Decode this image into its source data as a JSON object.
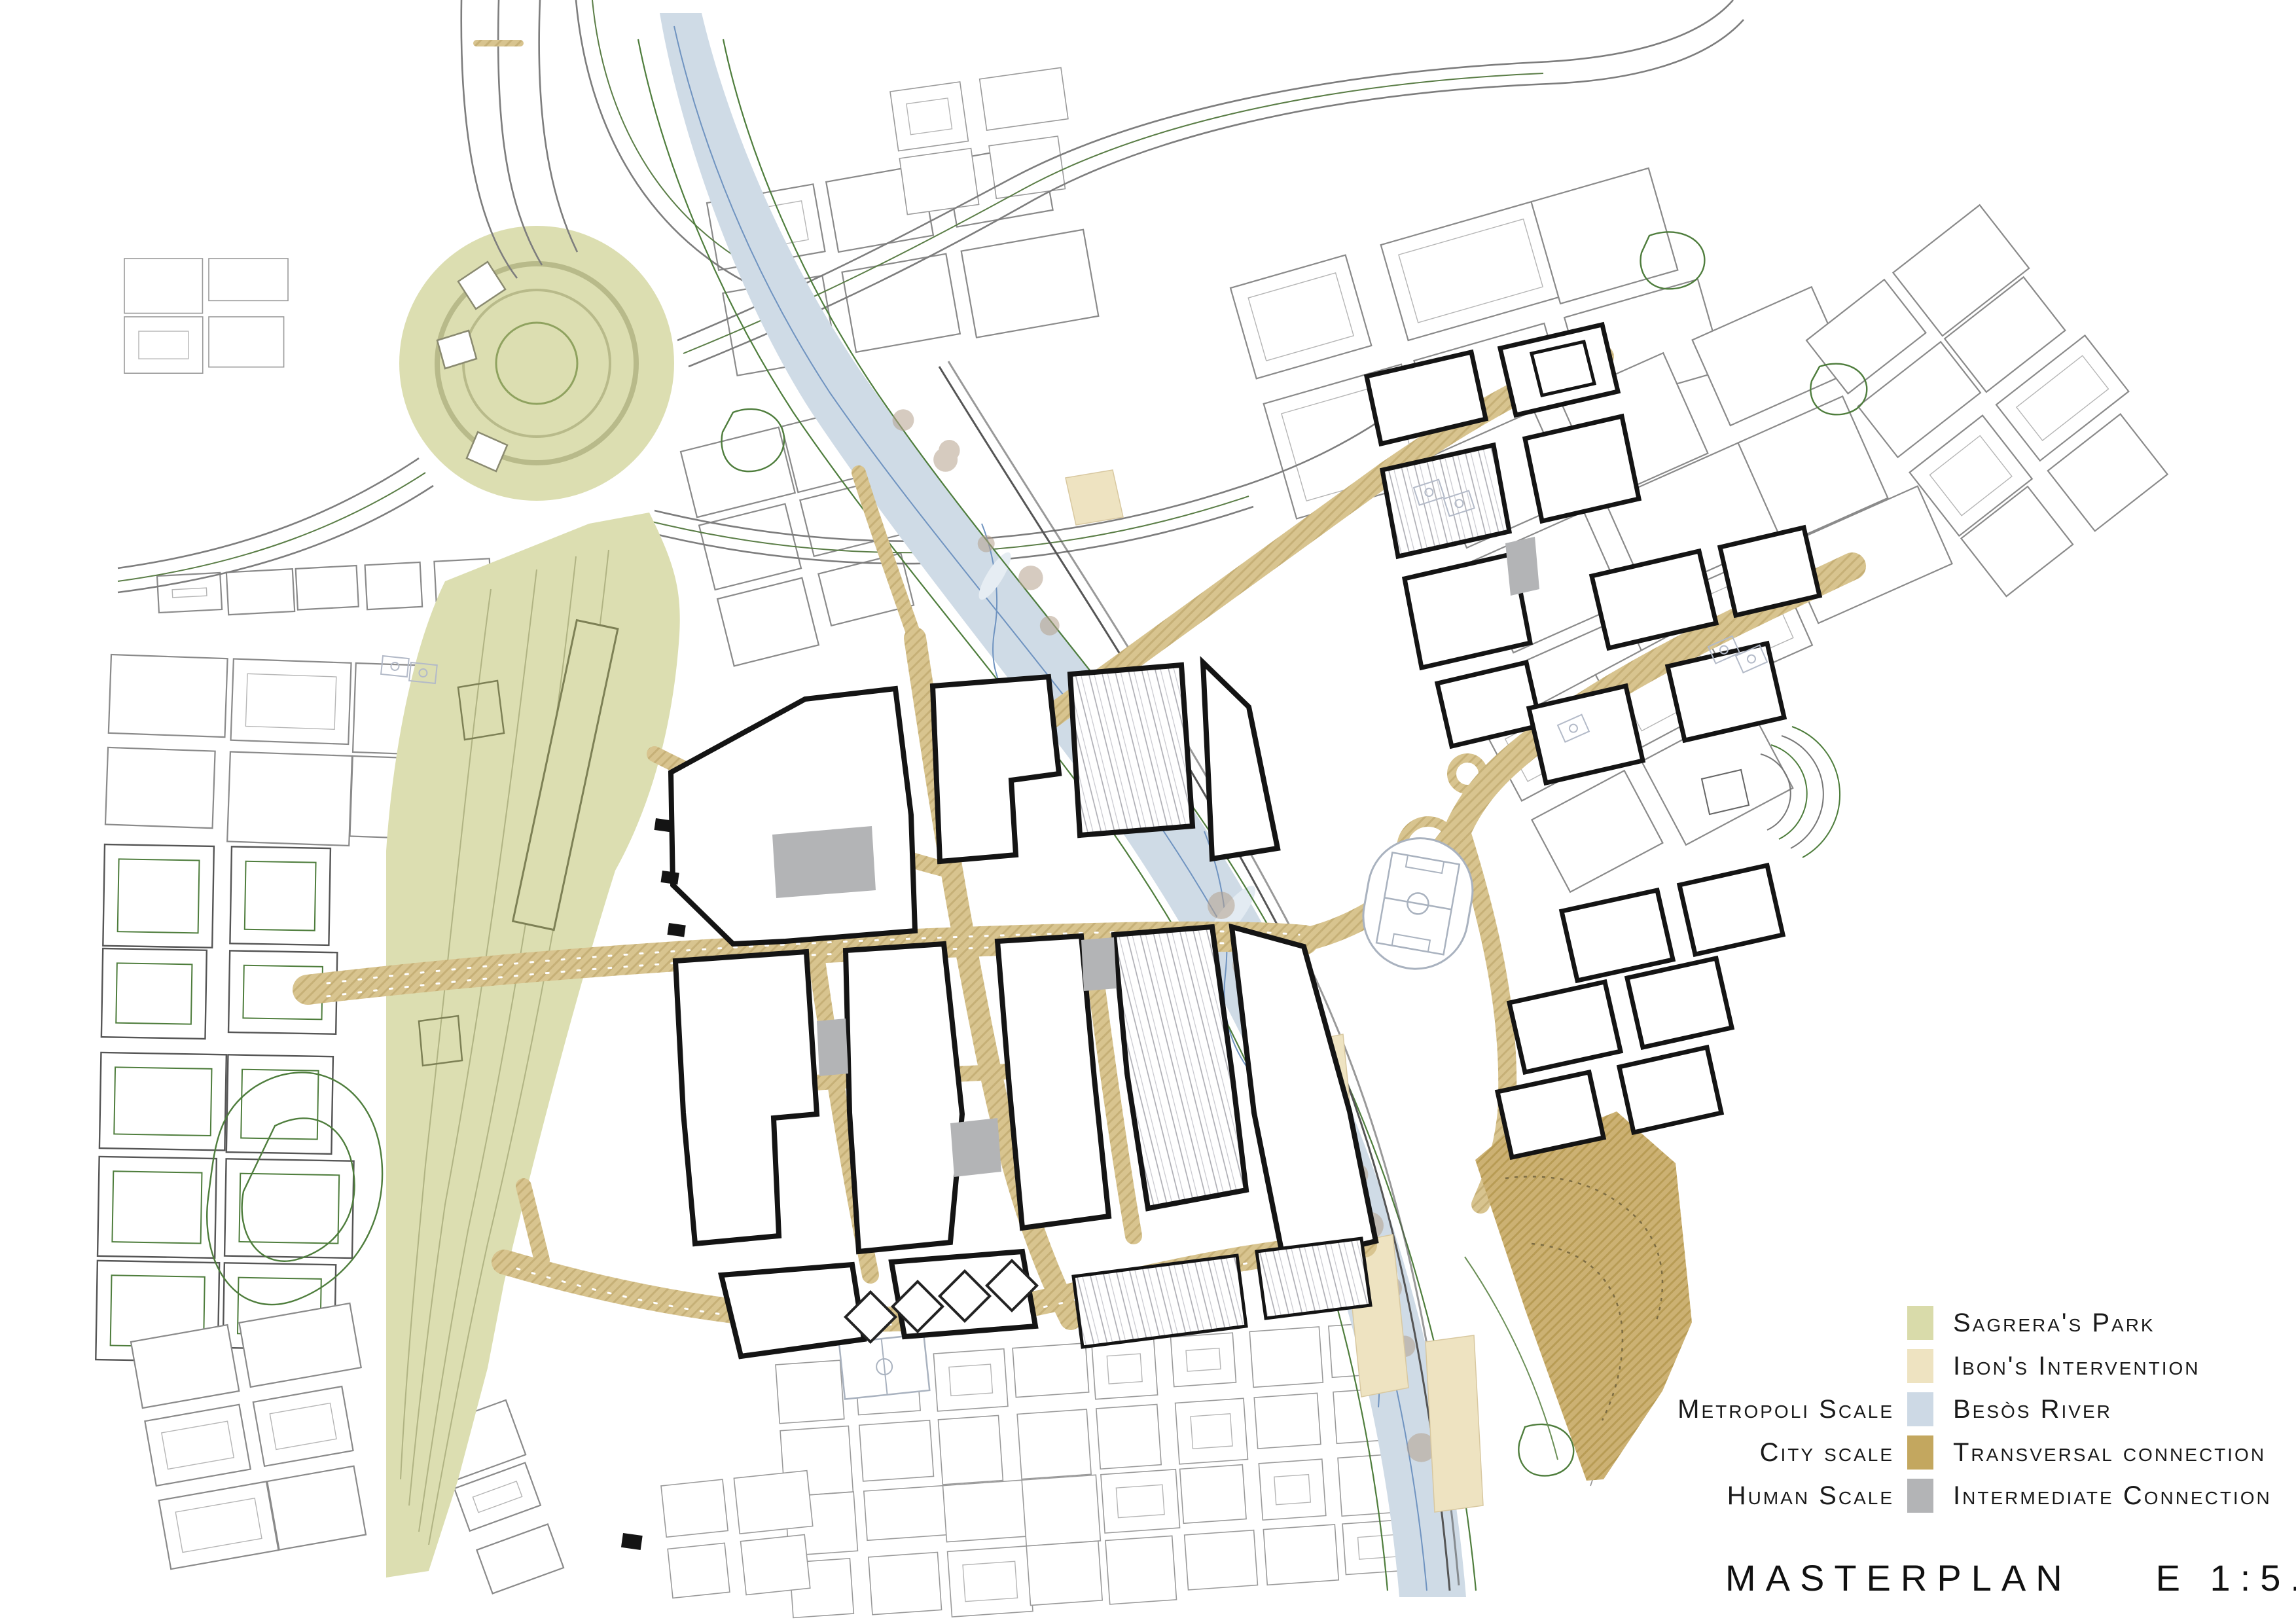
{
  "legend": {
    "rows": [
      {
        "scale_label": "",
        "swatch": "sagrera_park",
        "label": "Sagrera's Park"
      },
      {
        "scale_label": "",
        "swatch": "ibons_intervention",
        "label": "Ibon's Intervention"
      },
      {
        "scale_label": "Metropoli Scale",
        "swatch": "besos_river",
        "label": "Besòs River"
      },
      {
        "scale_label": "City scale",
        "swatch": "transversal_connection",
        "label": "Transversal connection"
      },
      {
        "scale_label": "Human Scale",
        "swatch": "intermediate_connection",
        "label": "Intermediate Connection"
      }
    ]
  },
  "title": {
    "text": "MASTERPLAN",
    "scale": "E 1:5.000"
  },
  "colors": {
    "sagrera_park": "#d9dbaa",
    "ibons_intervention": "#eee3c1",
    "besos_river": "#cdd9e5",
    "transversal_connection": "#c3a75f",
    "intermediate_connection": "#b3b4b6",
    "map_area_olive": "#dcdeb1",
    "map_road_tan": "#d8c48f",
    "map_bigpark_tan": "#ccb173",
    "map_river_blue": "#cfdbe6",
    "outline_black": "#141414",
    "thin_gray": "#8a8a8a",
    "green_line": "#4e7d3c",
    "water_line": "#6f93c0"
  }
}
